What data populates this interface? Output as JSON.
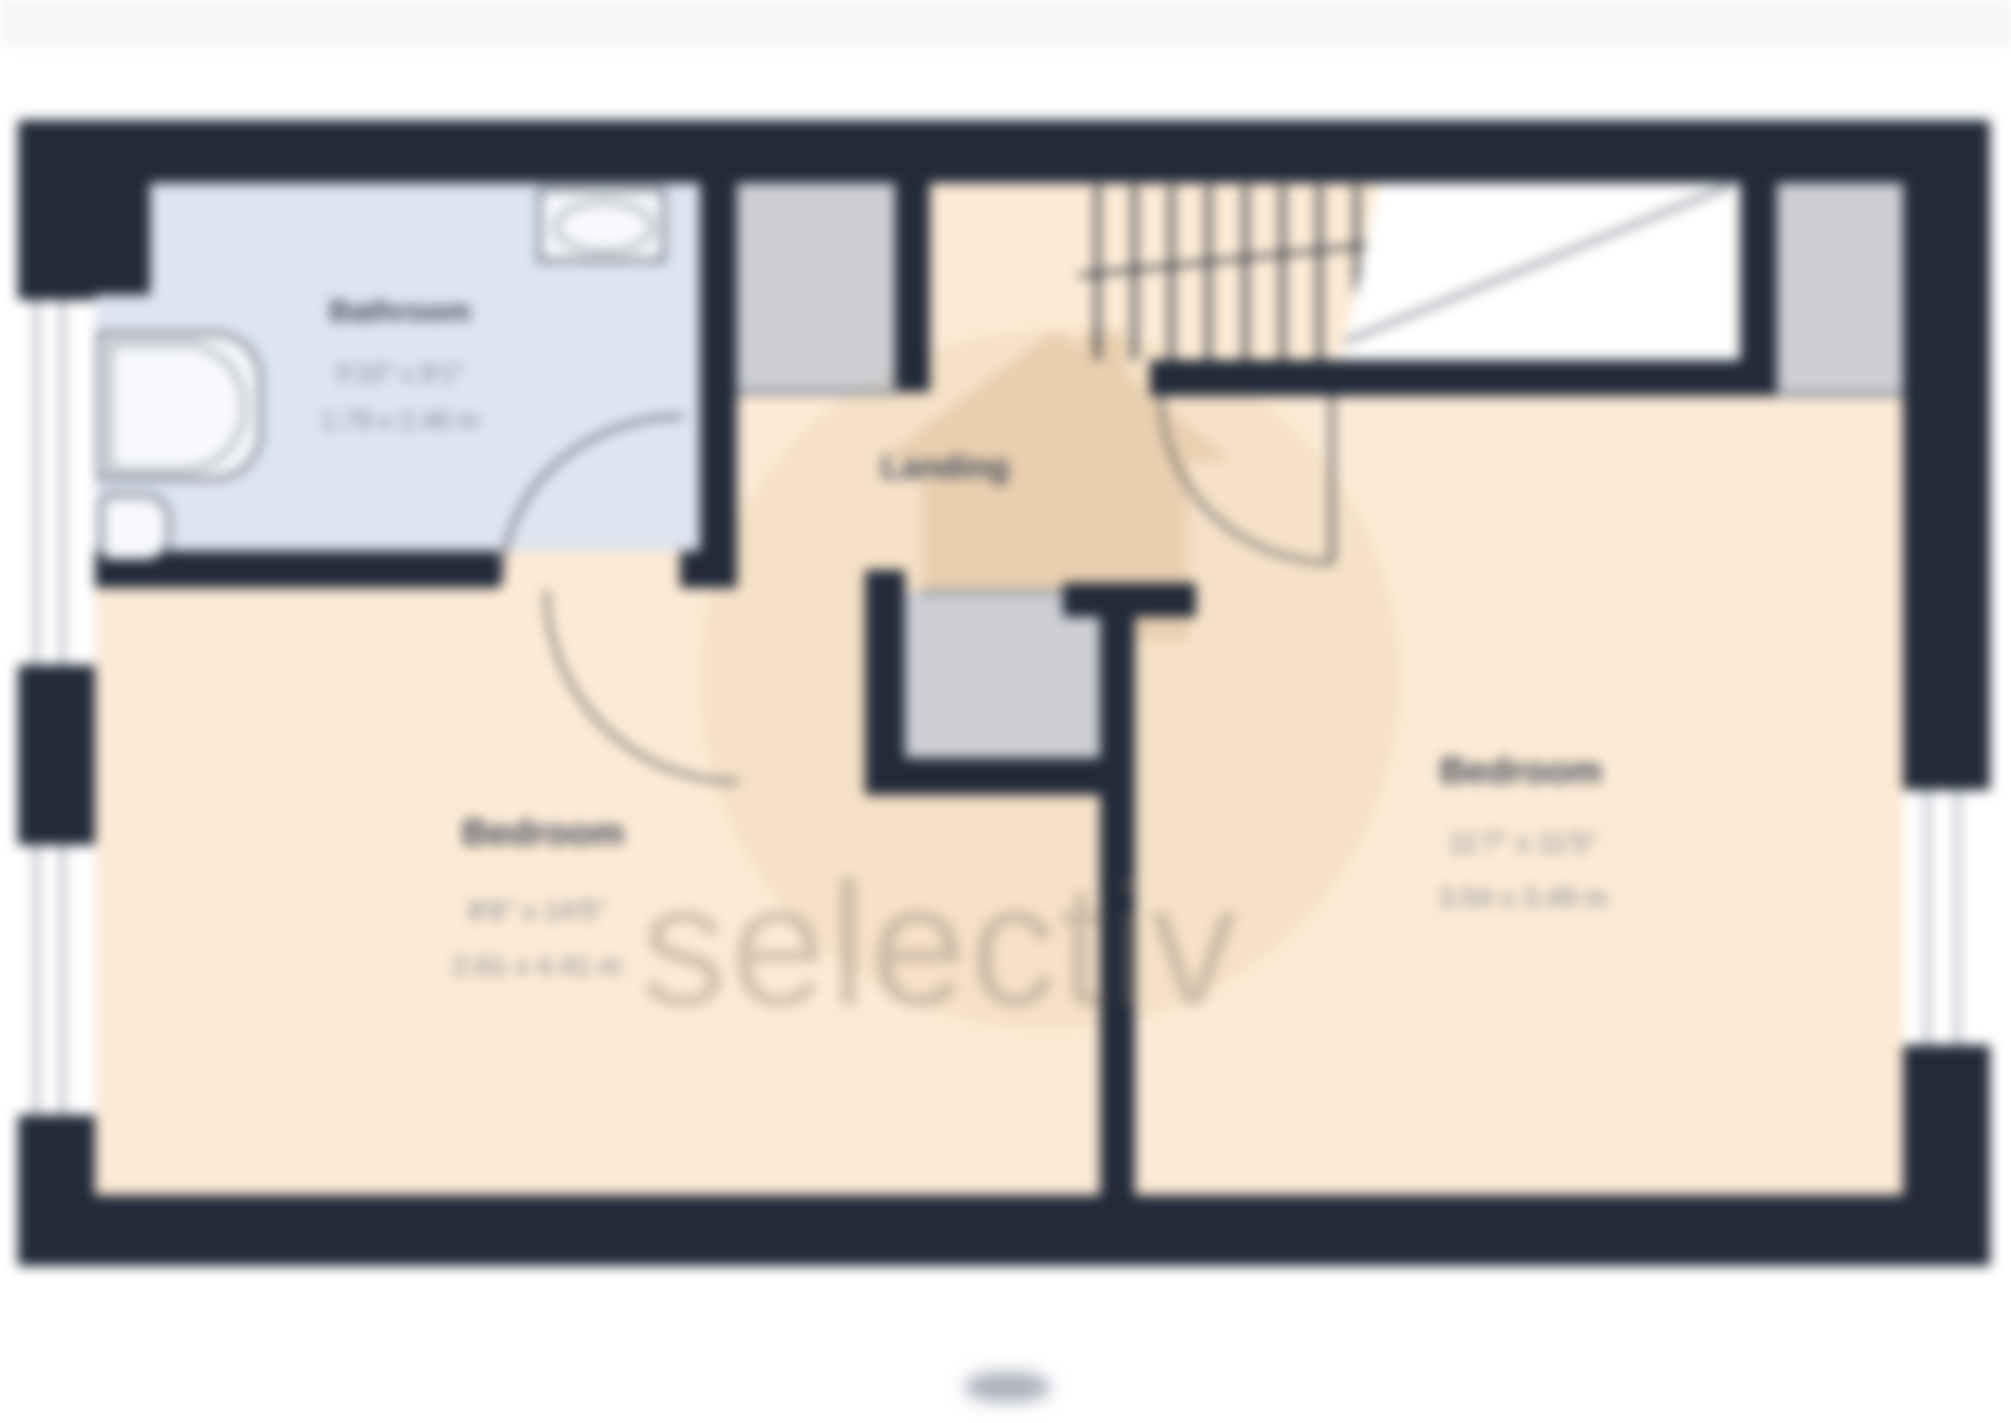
{
  "floorplan": {
    "colors": {
      "wall": "#222b3a",
      "room": "#fcead4",
      "bath": "#dee4f0",
      "closet": "#cdcfd4",
      "thinline": "#7d8491",
      "glaze": "#a8adb8",
      "fixture": "#2b3444",
      "label": "#3f4859",
      "dims": "#7c8494",
      "band": "#f5f6f8",
      "watermark": "rgba(125,110,100,0.32)"
    },
    "rooms": {
      "bathroom": {
        "label": "Bathroom",
        "dims_imperial": "5'10\" x 8'1\"",
        "dims_metric": "1.79 x 2.46 m"
      },
      "landing": {
        "label": "Landing"
      },
      "bedroom_left": {
        "label": "Bedroom",
        "dims_imperial": "8'6\" x 14'5\"",
        "dims_metric": "2.61 x 4.41 m"
      },
      "bedroom_right": {
        "label": "Bedroom",
        "dims_imperial": "11'7\" x 11'5\"",
        "dims_metric": "3.54 x 3.49 m"
      }
    },
    "watermark": {
      "text": "selectiv"
    }
  }
}
